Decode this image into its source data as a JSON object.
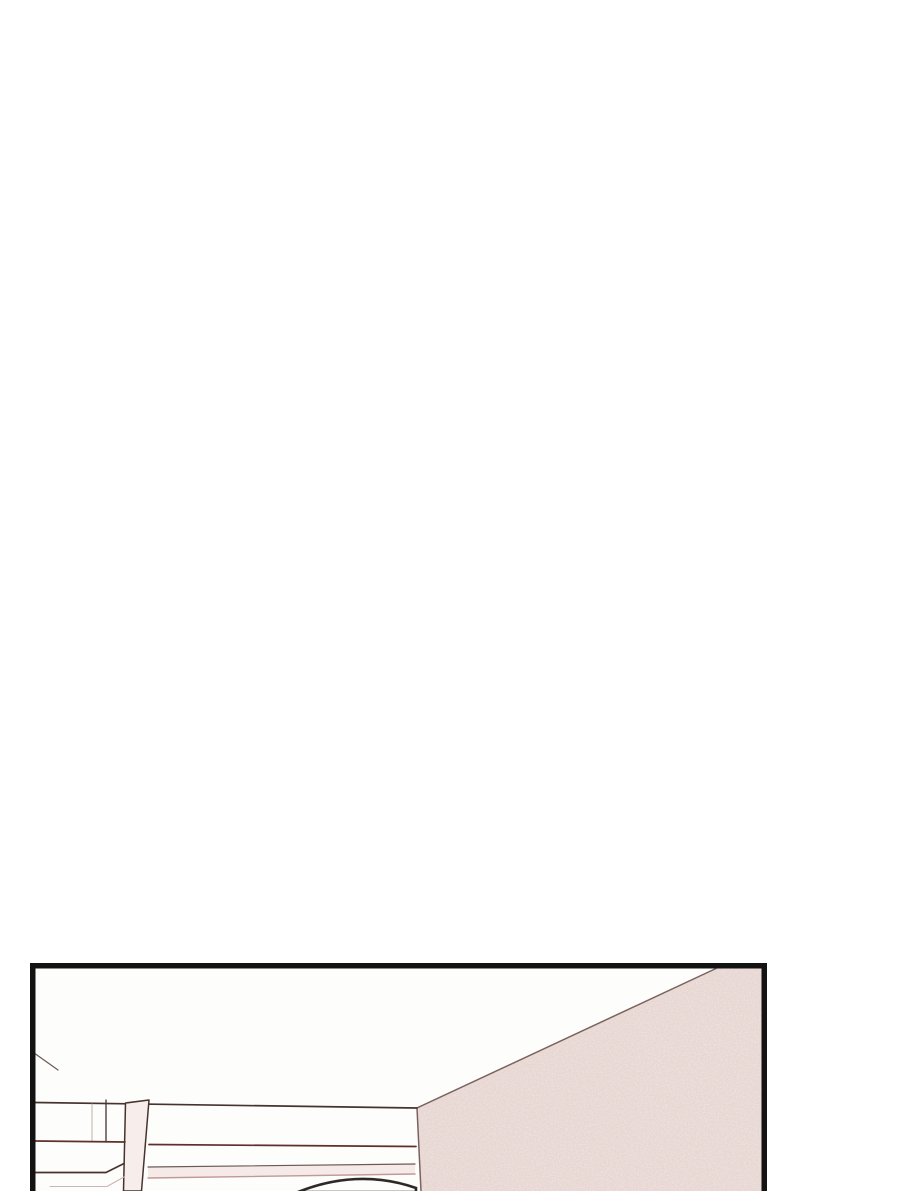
{
  "meta": {
    "type": "webtoon-comic-page",
    "scene": "Comic panel of a room interior: white ceiling, textured dusty-pink wall receding on the right, white shelving cabinet on the left, and the top of a character's head entering from the bottom edge of the panel"
  },
  "colors": {
    "page-bg": "#ffffff",
    "panel-bg": "#fdfdfc",
    "panel-border": "#131313",
    "wall": "#e7d6d2",
    "wall-speckle": "#f2e8e3",
    "wall-edge": "#7a625d",
    "line-dark": "#46332e",
    "line-red": "#5f2f2b",
    "line-soft": "#6b5a55",
    "line-faint": "#cdb6b1",
    "line-pink": "#c29a94",
    "post-fill": "#f7edeb",
    "band-pink": "#f5eae8",
    "head-line": "#2e2926"
  }
}
